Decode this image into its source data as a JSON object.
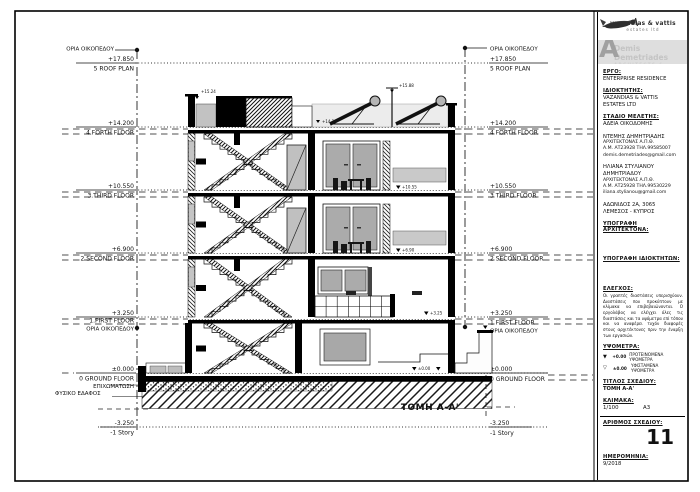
{
  "colors": {
    "ink": "#111111",
    "gray_dash": "#8a8a8a",
    "glass": "#ababab",
    "banner_bg": "#dedede"
  },
  "drawing": {
    "section_label": "ΤΟΜΗ A-A'",
    "boundary_label": "ΟΡΙΑ ΟΙΚΟΠΕΔΟΥ",
    "fill_label": "ΕΠΙΧΩΜΑΤΩΣΗ",
    "natural_ground_label": "ΦΥΣΙΚΟ ΕΔΑΦΟΣ",
    "levels_left": [
      {
        "value": "+17.850",
        "label": "5 ROOF PLAN"
      },
      {
        "value": "+14.200",
        "label": "4.FORTH FLOOR"
      },
      {
        "value": "+10.550",
        "label": "3.THIRD FLOOR"
      },
      {
        "value": "+6.900",
        "label": "2 SECOND FLOOR"
      },
      {
        "value": "+3.250",
        "label": "1.FIRST FLOOR"
      },
      {
        "value": "±0.000",
        "label": "0 GROUND FLOOR"
      },
      {
        "value": "-3.250",
        "label": "-1 Story"
      }
    ],
    "levels_right": [
      {
        "value": "+17.850",
        "label": "5 ROOF PLAN"
      },
      {
        "value": "+14.200",
        "label": "4 FORTH FLOOR"
      },
      {
        "value": "+10.550",
        "label": "3 THIRD FLOOR"
      },
      {
        "value": "+6.900",
        "label": "2 SECOND FLOOR"
      },
      {
        "value": "+3.250",
        "label": "1 FIRST FLOOR"
      },
      {
        "value": "±0.000",
        "label": "0 GROUND FLOOR"
      },
      {
        "value": "-3.250",
        "label": "-1 Story"
      }
    ],
    "markers": {
      "parapet_left": "+15.24",
      "roof_flag": "+15.88",
      "roof_slab": "+14.20",
      "floor4": "+10.55",
      "floor3": "+6.90",
      "floor2": "+3.25",
      "ground": "±0.00"
    }
  },
  "titleblock": {
    "logo": {
      "company": "vazandias & vattis",
      "sub": "estates ltd"
    },
    "banner": {
      "initial": "A",
      "name": "Demis Demetriades",
      "subtitle": "ARCHITECTS & ASSOCIATES"
    },
    "project": {
      "heading": "ΕΡΓΟ:",
      "value": "ENTERPRISE RESIDENCE"
    },
    "owner": {
      "heading": "ΙΔΙΟΚΤΗΤΗΣ:",
      "line1": "VAZANDIAS & VATTIS",
      "line2": "ESTATES LTD"
    },
    "stage": {
      "heading": "ΣΤΑΔΙΟ ΜΕΛΕΤΗΣ:",
      "value": "ΑΔΕΙΑ ΟΙΚΟΔΟΜΗΣ"
    },
    "architect1": {
      "line1": "ΝΤΕΜΗΣ ΔΗΜΗΤΡΙΑΔΗΣ",
      "line2": "ΑΡΧΙΤΕΚΤΟΝΑΣ Α.Π.Θ.",
      "line3": "Α.Μ. ΑΤ23928 ΤΗΛ.99585007",
      "line4": "demis.demetriades@gmail.com"
    },
    "architect2": {
      "line1": "ΗΛΙΑΝΑ ΣΤΥΛΙΑΝΟΥ",
      "line2": "ΔΗΜΗΤΡΙΑΔΟΥ",
      "line3": "ΑΡΧΙΤΕΚΤΟΝΑΣ Α.Π.Θ.",
      "line4": "Α.Μ. ΑΤ25928 ΤΗΛ.99530229",
      "line5": "iliana.stylianou@gmail.com"
    },
    "address": {
      "line1": "ΑΔΩΝΙΔΟΣ 2Α, 3065",
      "line2": "ΛΕΜΕΣΟΣ - ΚΥΠΡΟΣ"
    },
    "signatures": {
      "architect": "ΥΠΟΓΡΑΦΗ ΑΡΧΙΤΕΚΤΟΝΑ:",
      "owners": "ΥΠΟΓΡΑΦΗ ΙΔΙΟΚΤΗΤΩΝ:"
    },
    "control": {
      "heading": "ΕΛΕΓΧΟΣ:",
      "text": "Οι γραπτές διαστάσεις υπερισχύουν. Διαστάσεις που προκύπτουν με κλίμακα να επιβεβαιώνονται. Ο εργολάβος να ελέγχει όλες τις διαστάσεις και τα υψόμετρα επί τόπου και να αναφέρει τυχόν διαφορές στους αρχιτέκτονες πριν την έναρξη των εργασιών."
    },
    "elevations": {
      "heading": "ΥΨΟΜΕΤΡΑ:",
      "proposed_sym": "+0.00",
      "proposed": "ΠΡΟΤΕΙΝΟΜΕΝΑ ΥΨΟΜΕΤΡΑ",
      "existing_sym": "±0.00",
      "existing": "ΥΦΙΣΤΑΜΕΝΑ ΥΨΟΜΕΤΡΑ"
    },
    "title": {
      "heading": "ΤΙΤΛΟΣ ΣΧΕΔΙΟΥ:",
      "value": "ΤΟΜΗ A-A'"
    },
    "scale": {
      "heading": "ΚΛΙΜΑΚΑ:",
      "value": "1/100",
      "paper": "A3"
    },
    "number": {
      "heading": "ΑΡΙΘΜΟΣ ΣΧΕΔΙΟΥ:",
      "value": "11"
    },
    "date": {
      "heading": "ΗΜΕΡΟΜΗΝΙΑ:",
      "value": "9/2018"
    }
  }
}
